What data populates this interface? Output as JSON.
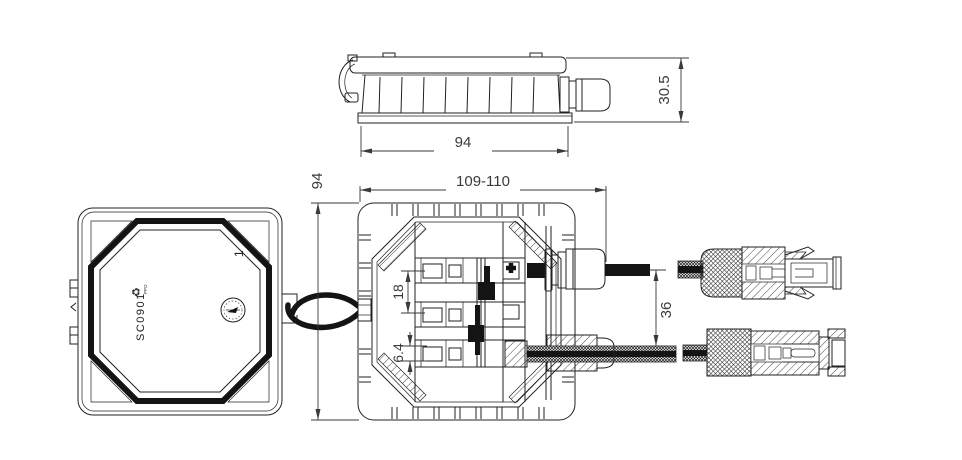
{
  "drawing": {
    "title": "junction-box-technical-drawing",
    "background": "#ffffff",
    "line_color": "#222222",
    "text_color": "#3a3a3a",
    "side_view": {
      "dims": {
        "width": "94",
        "height": "30.5"
      }
    },
    "top_view": {
      "dims": {
        "width": "109-110",
        "height": "94",
        "terminal_pitch": "18",
        "cable_diameter": "6.4",
        "cable_spacing": "36"
      }
    },
    "bottom_view": {
      "markings": {
        "part_number": "SC0901",
        "material": "PPO",
        "recycle_symbol": "♻",
        "cavity": "1"
      }
    }
  }
}
